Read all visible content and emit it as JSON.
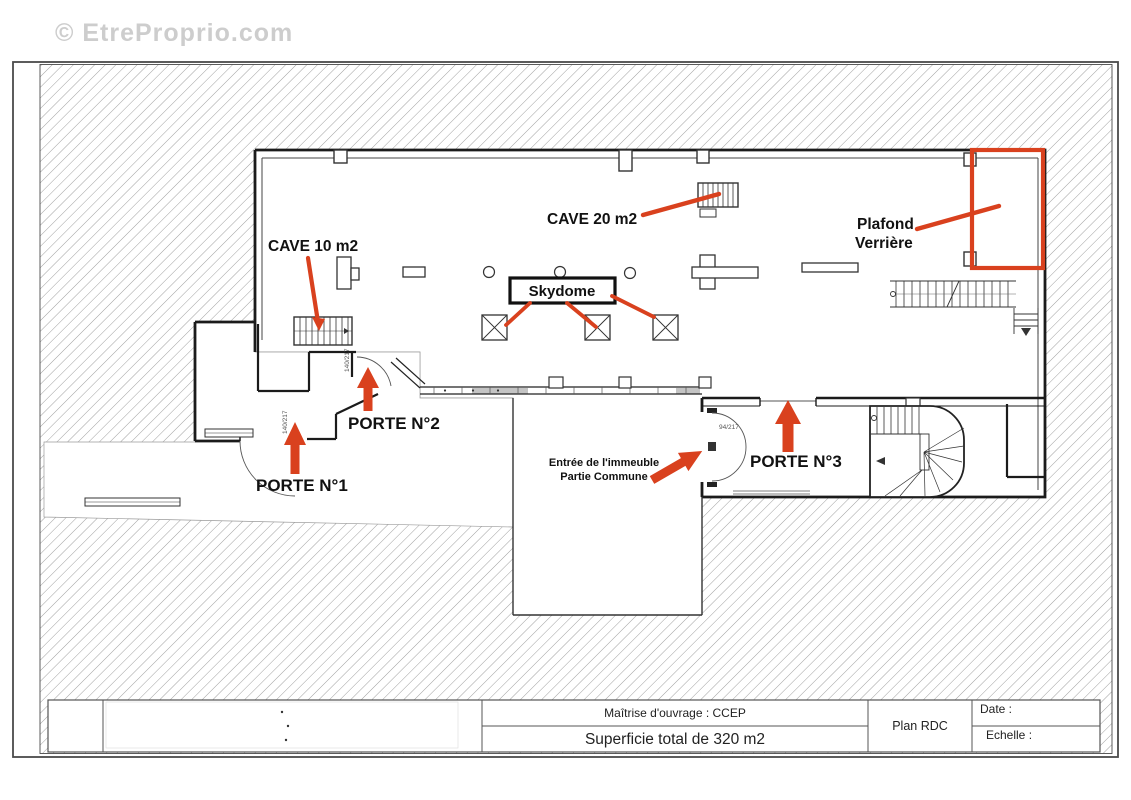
{
  "watermark": "© EtreProprio.com",
  "plan": {
    "labels": {
      "cave20": "CAVE 20 m2",
      "cave10": "CAVE 10 m2",
      "plafond_line1": "Plafond",
      "plafond_line2": "Verrière",
      "skydome": "Skydome",
      "porte1": "PORTE N°1",
      "porte2": "PORTE N°2",
      "porte3": "PORTE N°3",
      "entree_line1": "Entrée de l'immeuble",
      "entree_line2": "Partie Commune"
    },
    "door_dims": {
      "porte1": "140/217",
      "porte2": "140/217",
      "entree": "94/217"
    },
    "colors": {
      "annotation_red": "#d9411e",
      "wall_black": "#1b1b1b",
      "hatch_gray": "#8f8f8f"
    }
  },
  "title_block": {
    "maitrise": "Maîtrise d'ouvrage : CCEP",
    "superficie": "Superficie total de 320 m2",
    "plan_name": "Plan RDC",
    "date_label": "Date :",
    "echelle_label": "Echelle :"
  }
}
